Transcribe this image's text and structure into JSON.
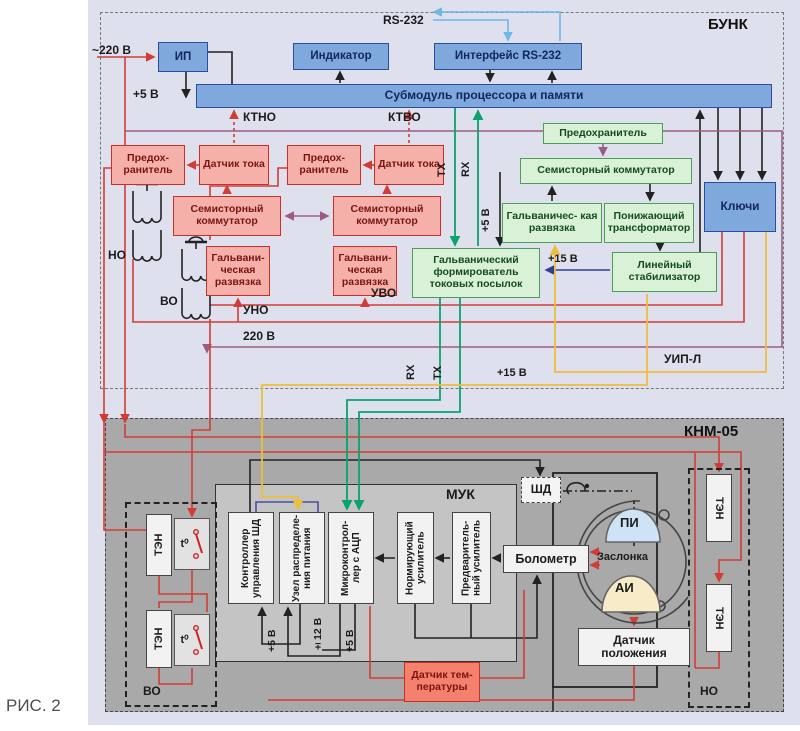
{
  "figure_label": "РИС. 2",
  "bunk": {
    "title": "БУНК",
    "ip": "ИП",
    "indicator": "Индикатор",
    "rs232": "RS-232",
    "rs232_interface": "Интерфейс RS-232",
    "submodule": "Субмодуль процессора и памяти",
    "fuse_small": "Предох- ранитель",
    "current_sensor": "Датчик тока",
    "semistor": "Семисторный коммутатор",
    "galv_small": "Гальвани- ческая развязка",
    "fuse_green": "Предохранитель",
    "galv_green": "Гальваничес- кая развязка",
    "step_down": "Понижающий трансформатор",
    "former": "Гальванический формирователь токовых посылок",
    "lin_stab": "Линейный стабилизатор",
    "keys": "Ключи",
    "labels": {
      "power_in": "~220 В",
      "plus5": "+5 В",
      "ktno": "КТНО",
      "ktvo": "КТВО",
      "tx": "TX",
      "rx": "RX",
      "plus15": "+15 В",
      "uno": "УНО",
      "uvo": "УВО",
      "no": "НО",
      "vo": "ВО",
      "v220": "220 В",
      "uipl": "УИП-Л"
    }
  },
  "knm": {
    "title": "КНМ-05",
    "muk": "МУК",
    "shd": "ШД",
    "ctrl": "Контроллер управления ШД",
    "dist": "Узел распределе- ния питания",
    "mcu": "Микроконтрол- лер с АЦП",
    "norm_amp": "Нормирующий усилитель",
    "pre_amp": "Предваритель- ный усилитель",
    "bolometer": "Болометр",
    "pos_sensor": "Датчик положения",
    "temp_sensor": "Датчик тем- пературы",
    "ten": "ТЭН",
    "t0": "t⁰",
    "pi": "ПИ",
    "ai": "АИ",
    "zaslonka": "Заслонка",
    "labels": {
      "plus5": "+5 В",
      "pm12": "±12 В",
      "vo": "ВО",
      "no": "НО"
    }
  },
  "colors": {
    "wire_red": "#d23c35",
    "wire_purple": "#9b5c84",
    "wire_green": "#0aa36e",
    "wire_yellow": "#edbe3c",
    "wire_navy": "#2e3f9a",
    "wire_lightblue": "#6fb7e4",
    "box_blue": "#7fa8dc",
    "box_green": "#d9f1d7",
    "box_pink": "#f5b1a9"
  }
}
